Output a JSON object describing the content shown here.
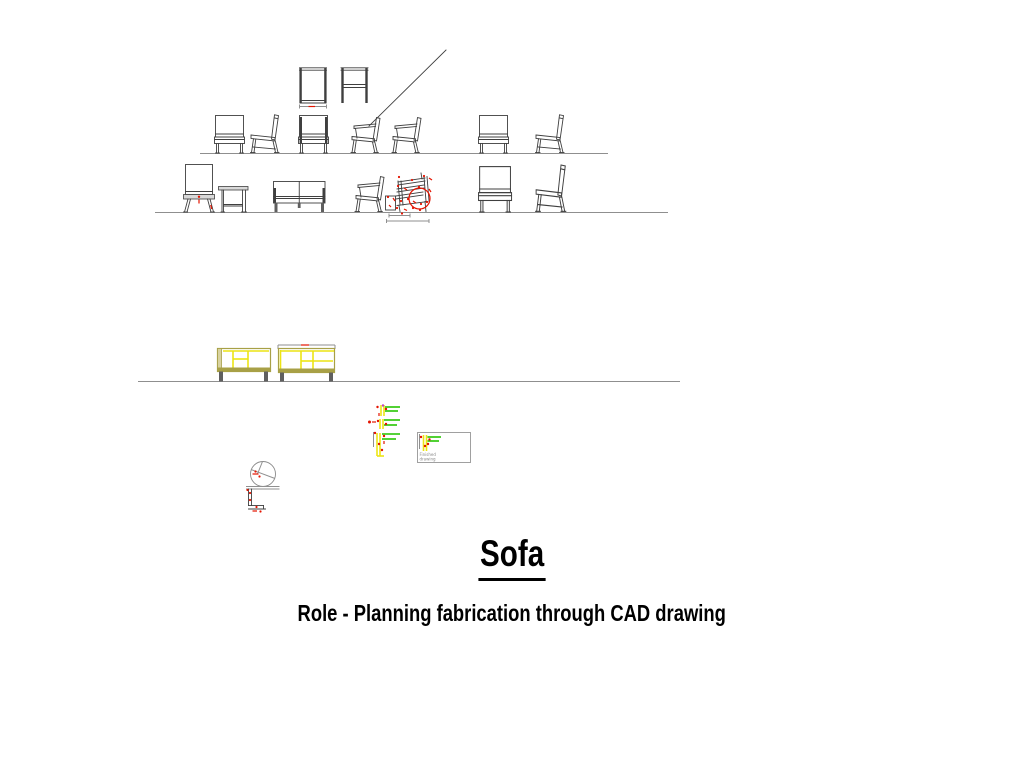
{
  "slide": {
    "title": "Sofa",
    "subtitle": "Role - Planning fabrication through CAD drawing"
  },
  "title_block": {
    "label_line1": "Finished",
    "label_line2": "drawing"
  },
  "colors": {
    "line_dark": "#3f3f3f",
    "line_gray": "#8f8f8f",
    "annotation_red": "#e41400",
    "frame_yellow": "#ece414",
    "frame_olive": "#a8a046",
    "fill_tan": "#d8d2a0",
    "leg_gray": "#5f5f5f",
    "detail_green": "#3ecc1e",
    "detail_magenta": "#c040c0",
    "seat_gray": "#d9d9d9",
    "text_black": "#000000"
  },
  "drawings": {
    "rows": [
      {
        "name": "concept-elevation-row-1",
        "items": [
          "chair-front",
          "chair-side",
          "chair-front-dark-posts",
          "armchair-side",
          "armchair-side",
          "chair-front",
          "chair-side"
        ]
      },
      {
        "name": "concept-elevation-row-2",
        "items": [
          "big-back-chair-front",
          "table-side",
          "two-seat-sofa-front",
          "armchair-side",
          "annotated-chair-side-with-dimensions",
          "chair-front",
          "chair-side"
        ]
      },
      {
        "name": "frame-elevation-row-3",
        "items": [
          "yellow-sofa-frame-front",
          "yellow-sofa-frame-front"
        ]
      }
    ],
    "details": [
      "chair-top-view",
      "frame-front-view",
      "joint-detail-cluster",
      "title-block",
      "leg-joint-detail-circle"
    ]
  }
}
